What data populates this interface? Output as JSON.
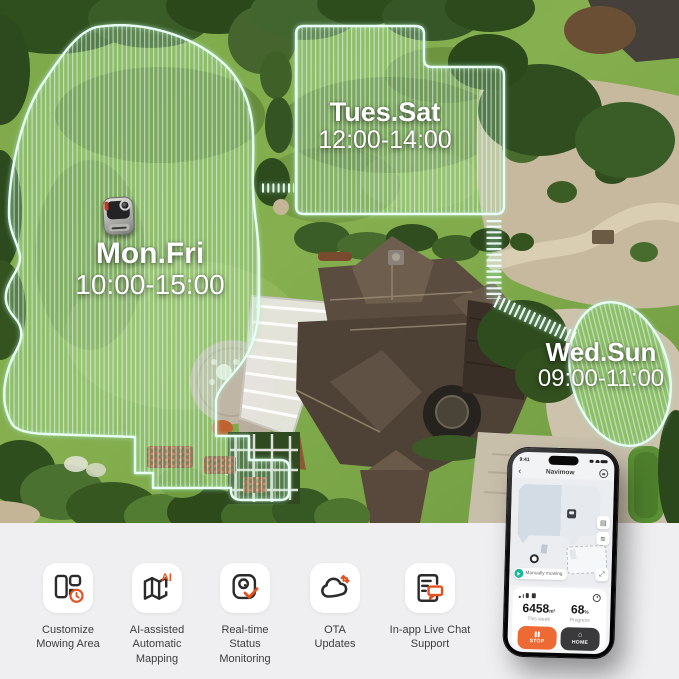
{
  "zones": [
    {
      "days": "Mon.Fri",
      "time": "10:00-15:00"
    },
    {
      "days": "Tues.Sat",
      "time": "12:00-14:00"
    },
    {
      "days": "Wed.Sun",
      "time": "09:00-11:00"
    }
  ],
  "phone": {
    "status_bar": {
      "time": "9:41"
    },
    "nav": {
      "back_icon": "‹",
      "title": "Navimow"
    },
    "map": {
      "status_chip": "Manually mowing",
      "fullscreen_icon": "⤢",
      "layers_icon": "▤",
      "list_icon": "≋"
    },
    "stats": {
      "area_value": "6458",
      "area_unit": "m²",
      "area_caption": "This week",
      "progress_value": "68",
      "progress_unit": "%",
      "progress_caption": "Progress"
    },
    "actions": {
      "stop": "STOP",
      "home": "HOME",
      "home_icon": "⌂"
    }
  },
  "features": [
    {
      "icon": "customize-mowing-area-icon",
      "label": "Customize Mowing Area"
    },
    {
      "icon": "ai-mapping-icon",
      "label": "AI-assisted Automatic Mapping"
    },
    {
      "icon": "status-monitoring-icon",
      "label": "Real-time Status Monitoring"
    },
    {
      "icon": "ota-updates-icon",
      "label": "OTA Updates"
    },
    {
      "icon": "chat-support-icon",
      "label": "In-app Live Chat Support"
    }
  ],
  "colors": {
    "accent_orange": "#e3511f",
    "stop_button": "#ed6a35",
    "home_button": "#3a3a3c",
    "chip_teal": "#18b79b",
    "zone_outline": "#e8fff5"
  }
}
